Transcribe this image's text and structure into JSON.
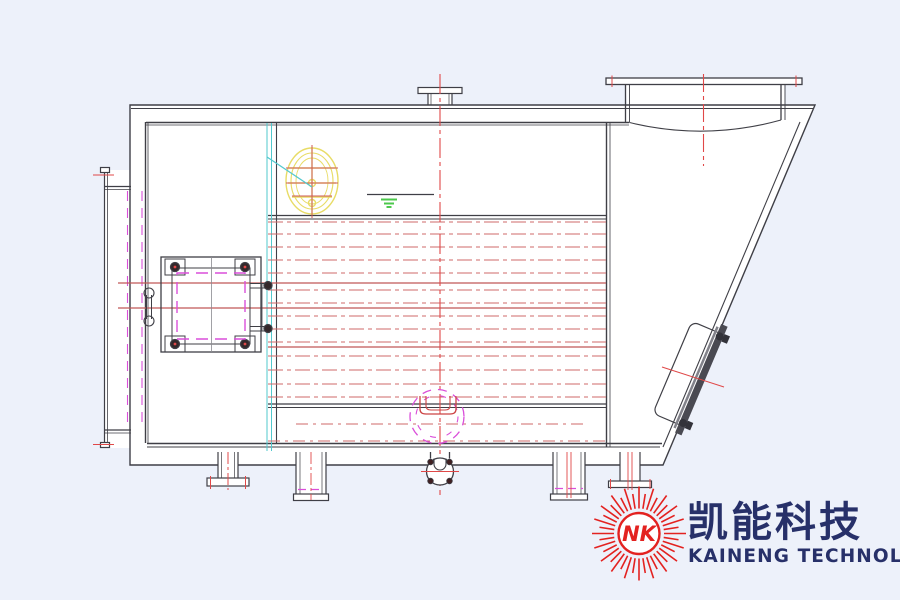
{
  "page": {
    "background": "#edf1fa"
  },
  "drawing": {
    "kind": "boiler-side-elevation-cad",
    "colors": {
      "background": "#edf1fa",
      "line": "#3f3f46",
      "centerline_red": "#e04848",
      "tube_red": "#cf6a6a",
      "magenta": "#da4fda",
      "yellow": "#e8dc66",
      "cyan": "#52c8ce",
      "green": "#4cc84c"
    },
    "tube_rows": {
      "x1": 268,
      "x2": 606,
      "extended_x1": 118,
      "dashed_y": [
        222,
        234,
        247,
        260,
        273,
        290,
        303,
        316,
        329,
        342,
        356,
        370,
        384,
        397
      ],
      "solid_extended_y": [
        283,
        308
      ],
      "solid_y": [
        347
      ],
      "lower_dashed": [
        {
          "y": 424,
          "x1": 296,
          "x2": 584
        },
        {
          "y": 441,
          "x1": 268,
          "x2": 606
        }
      ]
    },
    "sunburst": {
      "rays": 40,
      "inner_r": 25,
      "outer_r_short": 40,
      "outer_r_long": 47
    }
  },
  "logo": {
    "monogram": "NK",
    "company_cn": "凯能科技",
    "company_en": "KAINENG TECHNOLOGY",
    "red": "#e32220",
    "navy": "#273069"
  }
}
